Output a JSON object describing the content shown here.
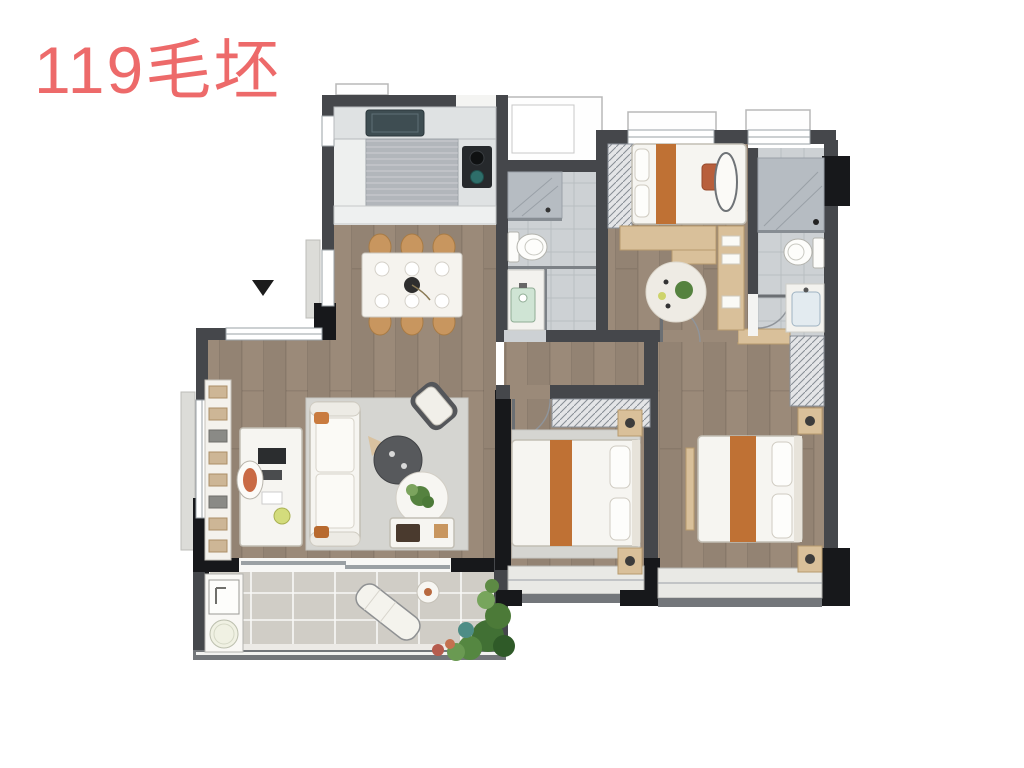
{
  "title": {
    "text": "119毛坯",
    "color": "#ed6a6a"
  },
  "marker": {
    "name": "direction-marker",
    "glyph": "▼",
    "color": "#1c1c1c"
  },
  "colors": {
    "title_red": "#ed6a6a",
    "wall": "#45474b",
    "wall_black": "#17181b",
    "wood": "#9b8a79",
    "cream": "#ece7de",
    "tile": "#cdd1d4",
    "tile_dark": "#b6bcc2",
    "balcony_tile": "#d0cdc6",
    "rug": "#d5d5d1",
    "furniture_white": "#f6f5f1",
    "furniture_border": "#c2beb4",
    "counter": "#dfe2e3",
    "counter_dark": "#b2b6bb",
    "orange_runner": "#bf7134",
    "chair_tan": "#c8965f",
    "wardrobe": "#e4e5e7",
    "plant": "#55823f",
    "plant_light": "#7ca45e",
    "teal": "#2e6e6a",
    "window": "#ffffff",
    "window_line": "#9aa0a6"
  }
}
